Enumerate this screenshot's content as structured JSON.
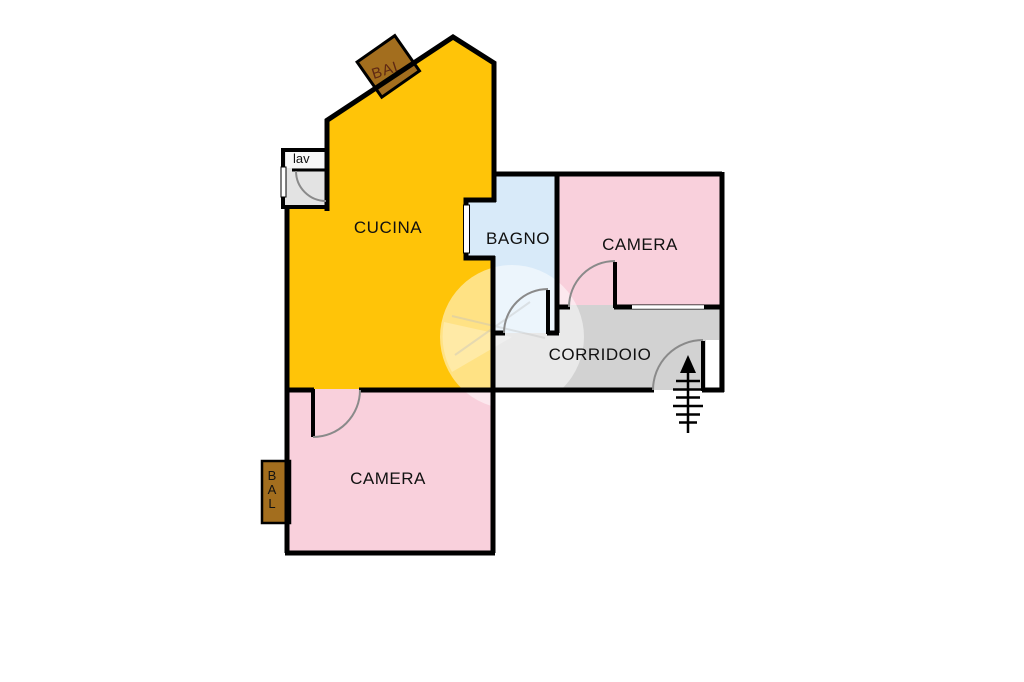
{
  "plan_title": "apartment-floor-plan",
  "colors": {
    "kitchen": "#FFC408",
    "bedroom": "#F9D0DC",
    "bathroom": "#D8EAF9",
    "corridor": "#D2D2D2",
    "laundry": "#E3E3E3",
    "laundry_label_bg": "#F7F7F7",
    "balcony": "#A36E1E",
    "balcony_text": "#5E2813",
    "wall": "#000000",
    "door_arc": "#8a8a8a"
  },
  "rooms": {
    "kitchen": {
      "label": "CUCINA"
    },
    "bathroom": {
      "label": "BAGNO"
    },
    "bedroom_top": {
      "label": "CAMERA"
    },
    "corridor": {
      "label": "CORRIDOIO"
    },
    "bedroom_bottom": {
      "label": "CAMERA"
    },
    "laundry": {
      "label": "lav"
    },
    "balcony_top": {
      "label": "BAL"
    },
    "balcony_left": {
      "letters": [
        "B",
        "A",
        "L"
      ]
    }
  }
}
